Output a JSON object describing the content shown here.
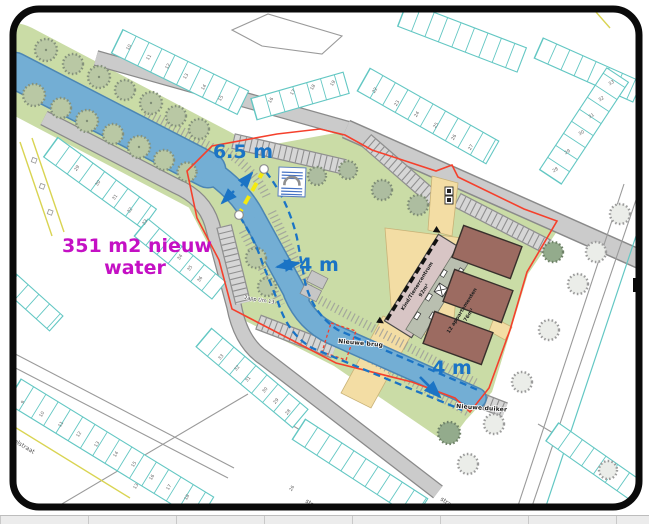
{
  "map": {
    "annotations": {
      "width_label_1": "6.5 m",
      "width_label_2": "4 m",
      "width_label_3": "4 m",
      "new_water_line_1": "351 m2 nieuw",
      "new_water_line_2": "water",
      "new_bridge_label": "Nieuwe brug",
      "new_culvert_label": "Nieuwe duiker",
      "apartments_note": "2app t/m 13"
    },
    "buildings": {
      "community_center_line_1": "Kind/Tienercentrum",
      "community_center_line_2": "92m²",
      "apartments_line_1": "12 appartementen",
      "apartments_line_2": "76m²"
    },
    "streets": {
      "bottom_left": "ffelstraat",
      "left": "straat",
      "bottom_right_a": "straat",
      "bottom_right_b": "straat"
    },
    "house_numbers": {
      "top_row": [
        "10",
        "11",
        "12",
        "13",
        "14",
        "15"
      ],
      "top_row_2": [
        "16",
        "17",
        "18",
        "19"
      ],
      "north_row": [
        "22",
        "23",
        "24",
        "25",
        "26",
        "27"
      ],
      "ne_block": [
        "33",
        "32",
        "31",
        "30",
        "29",
        "28"
      ],
      "west_row": [
        "29",
        "30",
        "31",
        "32",
        "33"
      ],
      "west_row_2": [
        "34",
        "35",
        "36"
      ],
      "bottom_row": [
        "9",
        "10",
        "11",
        "12",
        "13",
        "14",
        "15",
        "16",
        "17",
        "18"
      ],
      "bottom_mid": [
        "33",
        "32",
        "31",
        "30",
        "29",
        "28"
      ],
      "bottom_right": [
        "13",
        "26"
      ]
    },
    "colors": {
      "water": "#73AED4",
      "bank_green": "#CADCA6",
      "road": "#CBCBCB",
      "path_tan": "#F3DDA4",
      "community_center": "#D8C5C5",
      "apartments": "#9C6B61",
      "boundary_red": "#F5402C",
      "annotation_blue": "#1B74C5",
      "new_water_magenta": "#C410C4",
      "measure_yellow": "#F4EA0E",
      "house_outline": "#63C7C3"
    }
  }
}
